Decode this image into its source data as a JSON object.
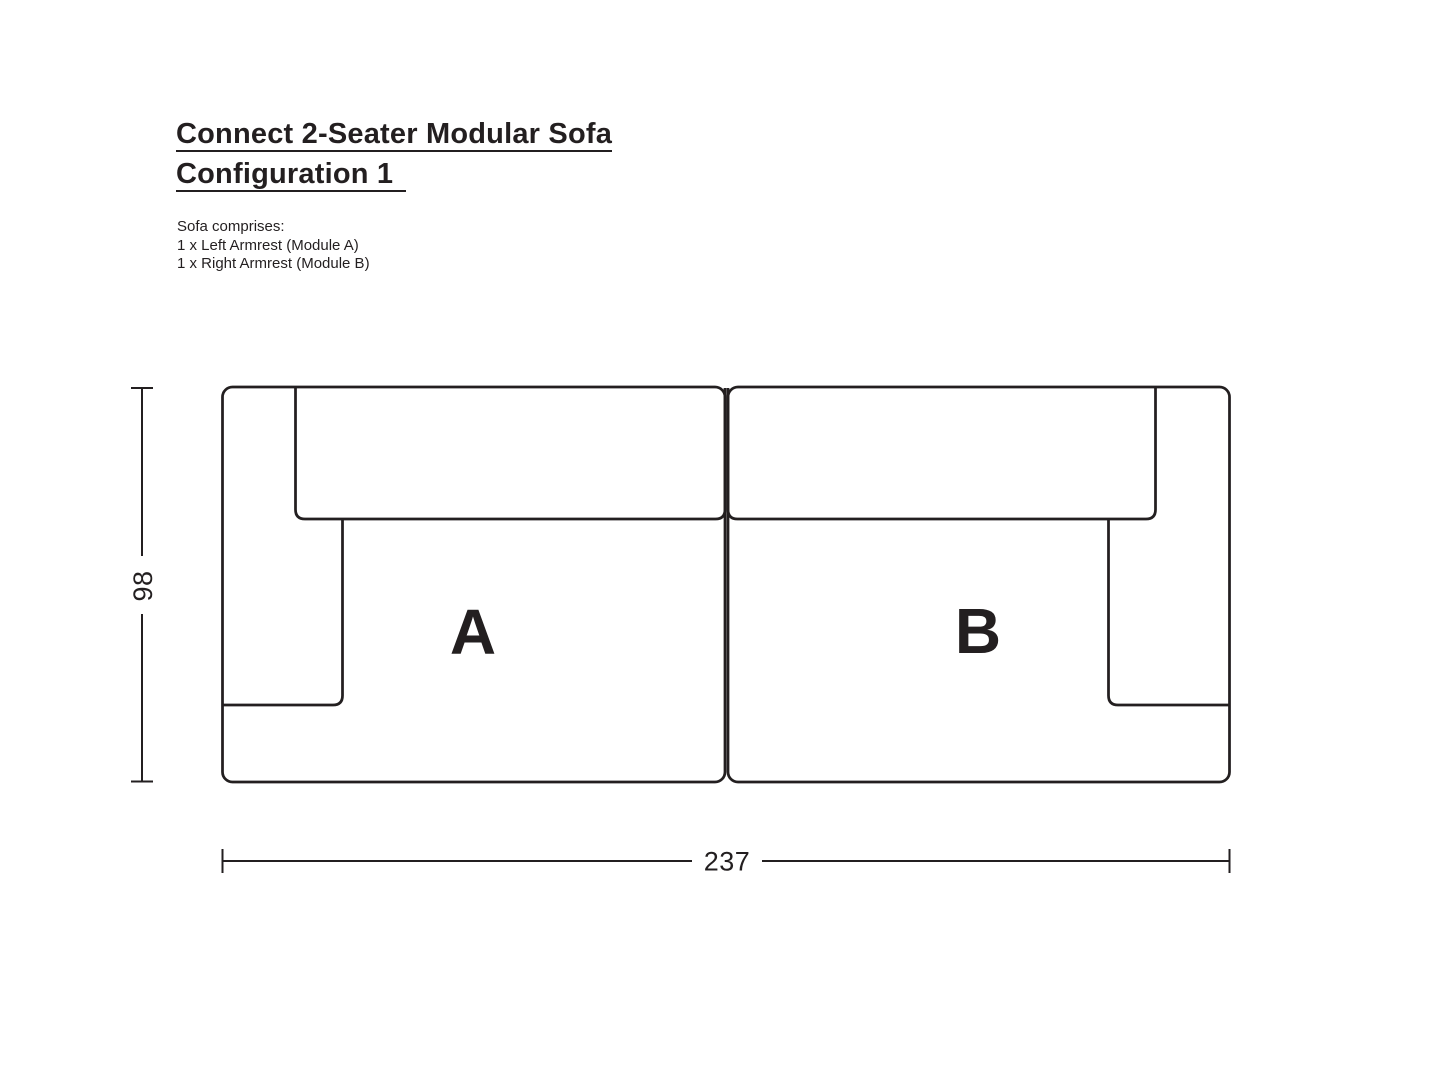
{
  "page": {
    "background_color": "#ffffff",
    "ink_color": "#231f20"
  },
  "title": {
    "line1": "Connect 2-Seater Modular Sofa",
    "line2": "Configuration 1"
  },
  "description": {
    "heading": "Sofa comprises:",
    "items": [
      "1 x Left Armrest (Module A)",
      "1 x Right Armrest (Module B)"
    ]
  },
  "diagram": {
    "view": "top-down plan of two-module sofa",
    "modules": [
      {
        "id": "A",
        "label": "A",
        "part": "Left Armrest (Module A)"
      },
      {
        "id": "B",
        "label": "B",
        "part": "Right Armrest (Module B)"
      }
    ],
    "dimensions": {
      "depth_cm": "98",
      "width_cm": "237"
    }
  }
}
